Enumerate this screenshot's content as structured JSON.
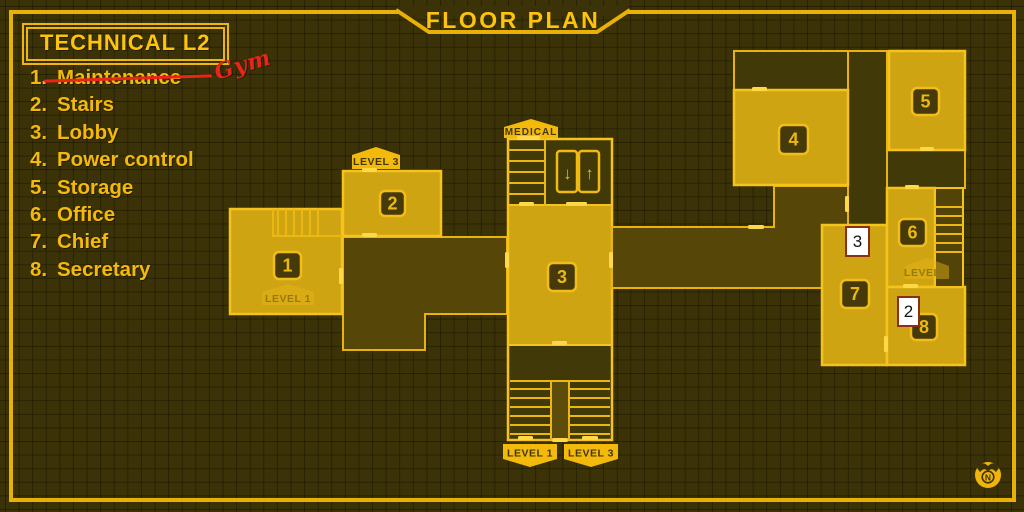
{
  "header": {
    "title": "FLOOR PLAN"
  },
  "legend": {
    "title": "TECHNICAL L2",
    "items": [
      {
        "num": "1.",
        "label": "Maintenance",
        "struck": true,
        "note": "Gym"
      },
      {
        "num": "2.",
        "label": "Stairs"
      },
      {
        "num": "3.",
        "label": "Lobby"
      },
      {
        "num": "4.",
        "label": "Power control"
      },
      {
        "num": "5.",
        "label": "Storage"
      },
      {
        "num": "6.",
        "label": "Office"
      },
      {
        "num": "7.",
        "label": "Chief"
      },
      {
        "num": "8.",
        "label": "Secretary"
      }
    ]
  },
  "plan": {
    "rooms": [
      {
        "num": "1"
      },
      {
        "num": "2"
      },
      {
        "num": "3"
      },
      {
        "num": "4"
      },
      {
        "num": "5"
      },
      {
        "num": "6"
      },
      {
        "num": "7"
      },
      {
        "num": "8"
      }
    ],
    "badges": {
      "level3_top": "LEVEL 3",
      "level1_room1": "LEVEL 1",
      "medical": "MEDICAL",
      "level1_bottom": "LEVEL 1",
      "level3_bottom": "LEVEL 3",
      "level1_room6": "LEVEL 1"
    },
    "elevator": {
      "down": "↓",
      "up": "↑"
    }
  },
  "marks": [
    {
      "label": "3"
    },
    {
      "label": "2"
    }
  ],
  "compass": {
    "label": "N"
  },
  "colors": {
    "background": "#3b3307",
    "accent": "#e9b006",
    "accent_bright": "#ffc30a",
    "room_fill": "#cfa413",
    "corridor_fill": "#564708",
    "annotation_red": "#ea2418",
    "mark_background": "#ffffff",
    "mark_border": "#8c2e12"
  }
}
